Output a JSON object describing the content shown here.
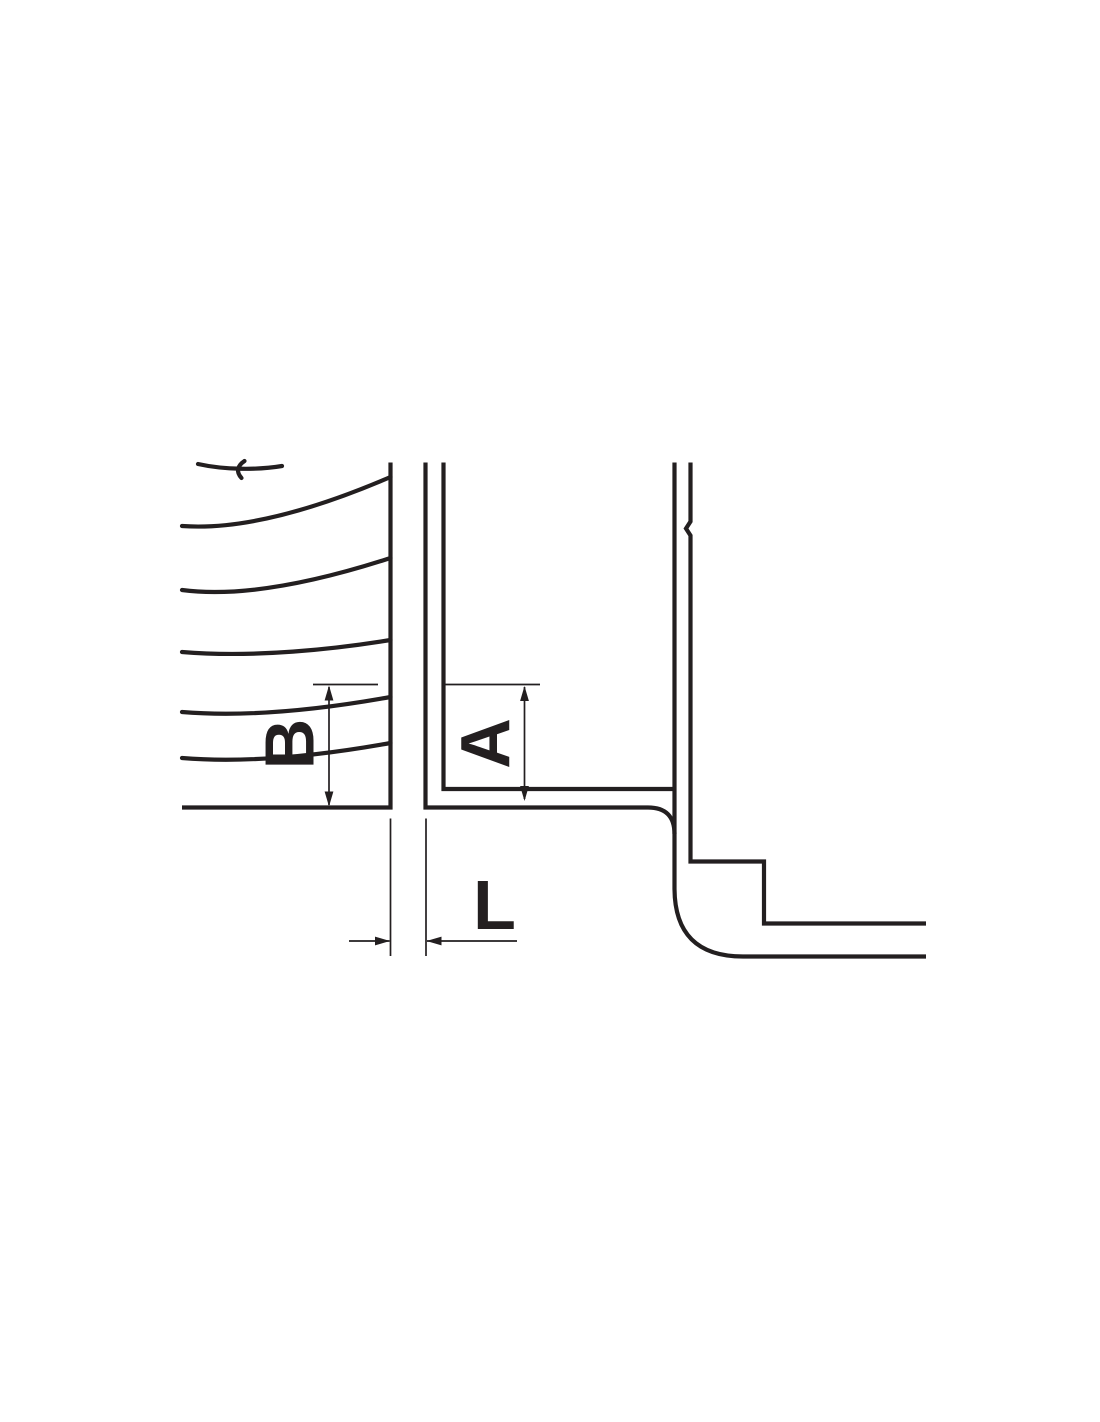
{
  "figure": {
    "colors": {
      "background": "#ffffff",
      "ink": "#231f20"
    },
    "stroke": {
      "thick": 4.2,
      "thin": 1.7
    },
    "labels": {
      "b": {
        "text": "B"
      },
      "a": {
        "text": "A"
      },
      "l": {
        "text": "L"
      }
    },
    "paths": {
      "left_outline": "M390.5,462.5 L390.5,807.5 L182,807.5",
      "flow1": "M198,464 C225,470 258,470 282,466",
      "flow1b": "M244.5,461 C237,466 236,472 241.5,478",
      "flow2": "M182,526 C250,531 330,503 390.5,477",
      "flow3": "M182,590 C250,599 335,576 390.5,558",
      "flow4": "M182,652 C255,658 335,649 390.5,640",
      "flow5": "M182,712 C255,718 335,707 390.5,697",
      "flow6": "M182,758 C255,764 335,753 390.5,743",
      "tube_outer": "M425.5,462.5 L425.5,807.5 L648,807.5 Q674.5,807.5 674.5,834",
      "tube_inner": "M443.5,462.5 L443.5,789 L674.5,789",
      "tube_right_wall": "M674.5,462.5 L674.5,888 Q674.5,956.5 743,956.5 L926,956.5",
      "right_profile": "M690.5,462.5 L690.5,521.5 L686,528.5 L690.5,535.5 L690.5,861.5 L764,861.5 L764,923.5 L926,923.5",
      "dim_b_ext": "M313,684.5 L378,684.5",
      "dim_b_line": "M329,687 L329,805",
      "dim_b_arrow_up": "M329,685.5 L324.6,700.5 L333.4,700.5 Z",
      "dim_b_arrow_down": "M329,806.5 L324.6,791.5 L333.4,791.5 Z",
      "dim_a_ext": "M442,684.5 L540,684.5",
      "dim_a_line": "M524.5,687 L524.5,799",
      "dim_a_arrow_up": "M524.5,686 L520.1,701 L528.9,701 Z",
      "dim_a_arrow_down": "M524.5,801 L520.1,786 L528.9,786 Z",
      "dim_l_ext_left": "M390.5,818.5 L390.5,956",
      "dim_l_ext_right": "M426,818.5 L426,956",
      "dim_l_line_left": "M349,941 L389.5,941",
      "dim_l_line_right": "M427,941 L517,941",
      "dim_l_arrow_right": "M390,941 L375,936.6 L375,945.4 Z",
      "dim_l_arrow_left": "M426.5,941 L441.5,936.6 L441.5,945.4 Z"
    }
  }
}
